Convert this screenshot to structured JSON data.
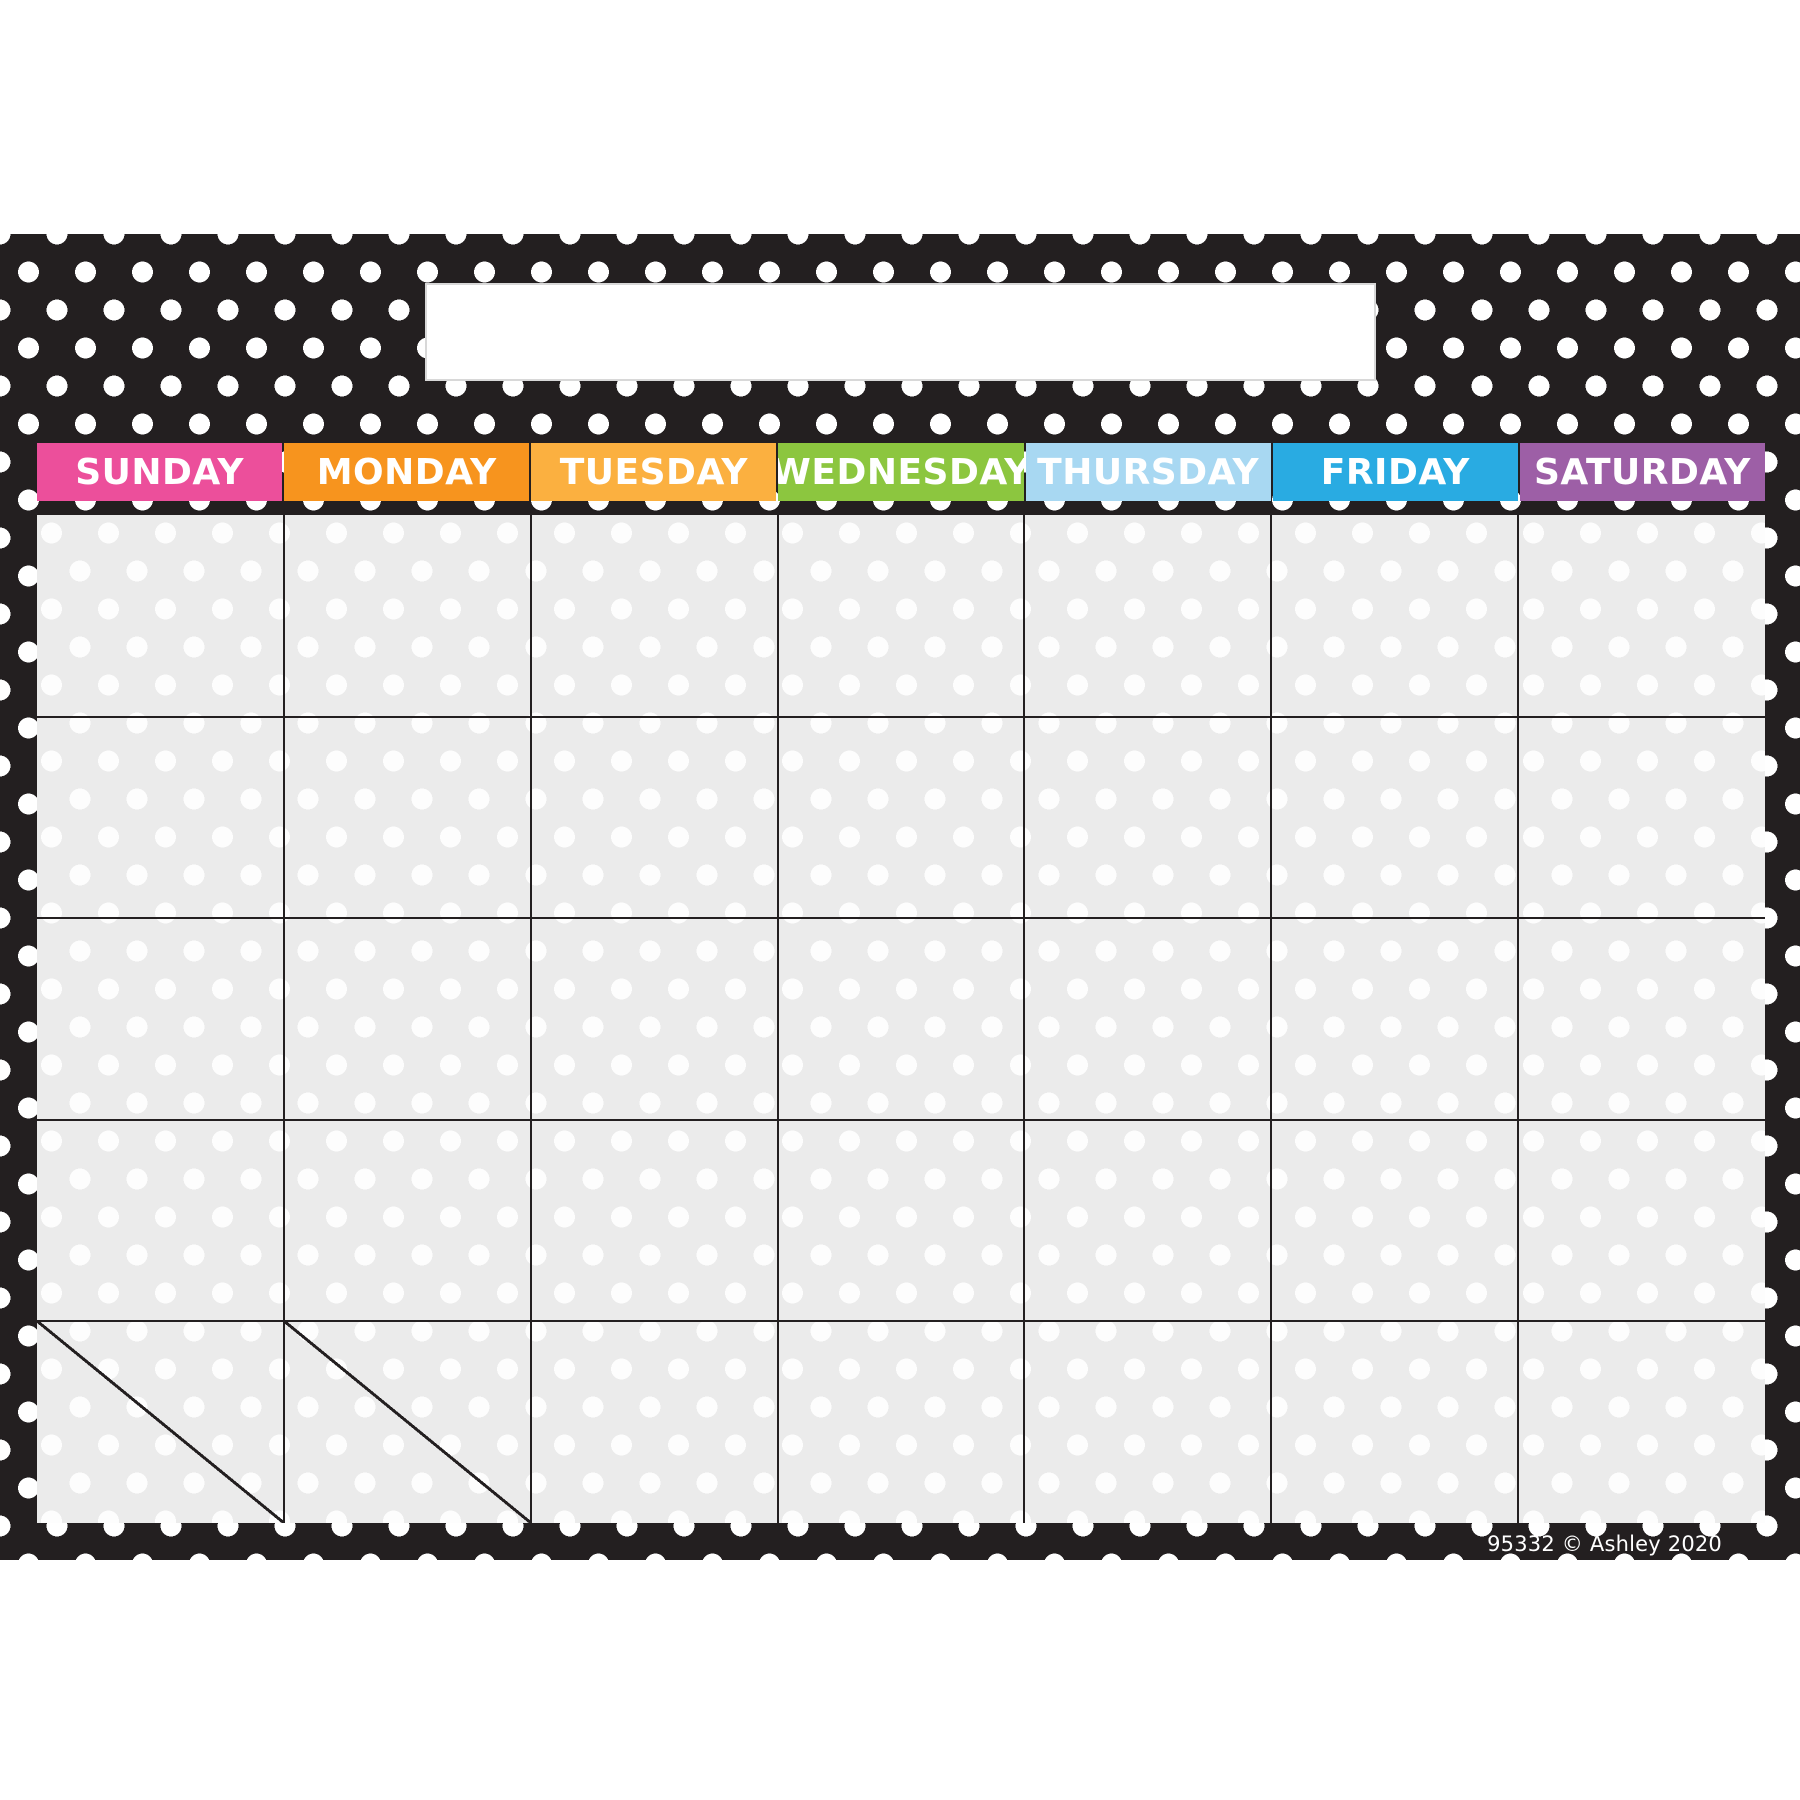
{
  "page": {
    "background": "#FFFFFF"
  },
  "poster": {
    "copyright": "95332 © Ashley 2020",
    "colors": {
      "border_black": "#231F20",
      "border_dot_white": "#FFFFFF",
      "cell_gray": "#EBEBEB",
      "cell_dot_white": "#FDFDFD",
      "title_box_white": "#FFFFFF"
    }
  },
  "calendar": {
    "month_title": "",
    "day_headers": [
      {
        "label": "SUNDAY",
        "color": "#EC4F9B"
      },
      {
        "label": "MONDAY",
        "color": "#F7941E"
      },
      {
        "label": "TUESDAY",
        "color": "#FBB040"
      },
      {
        "label": "WEDNESDAY",
        "color": "#8CC63F"
      },
      {
        "label": "THURSDAY",
        "color": "#A8D8F2"
      },
      {
        "label": "FRIDAY",
        "color": "#29ABE2"
      },
      {
        "label": "SATURDAY",
        "color": "#9D5FA6"
      }
    ],
    "grid": {
      "rows": 5,
      "columns": 7,
      "split_cells": [
        [
          5,
          1
        ],
        [
          5,
          2
        ]
      ],
      "cells_empty": true
    }
  }
}
